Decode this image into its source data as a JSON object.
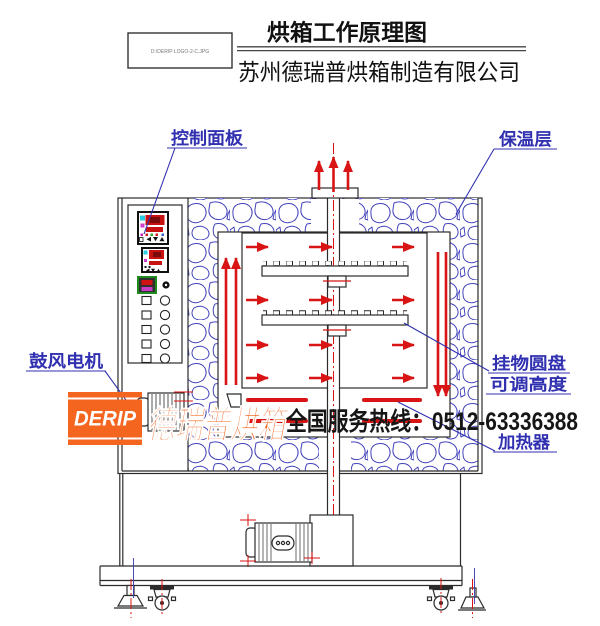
{
  "header": {
    "file_label": "D:\\DERIP LOGO-2-C.JPG",
    "title": "烘箱工作原理图",
    "company": "苏州德瑞普烘箱制造有限公司"
  },
  "labels": {
    "control_panel": "控制面板",
    "insulation_layer": "保温层",
    "blower_motor": "鼓风电机",
    "hanging_disc": "挂物圆盘",
    "adjustable_height": "可调高度",
    "heater": "加热器"
  },
  "watermark": {
    "logo_text": "DERIP",
    "brand_text": "德瑞普烘箱",
    "hotline_text": "全国服务热线：0512-63336388"
  },
  "colors": {
    "diagram_blue": "#3030b0",
    "arrow_red": "#d81414",
    "brand_orange": "#f4661f",
    "line_black": "#2b2b2b"
  }
}
